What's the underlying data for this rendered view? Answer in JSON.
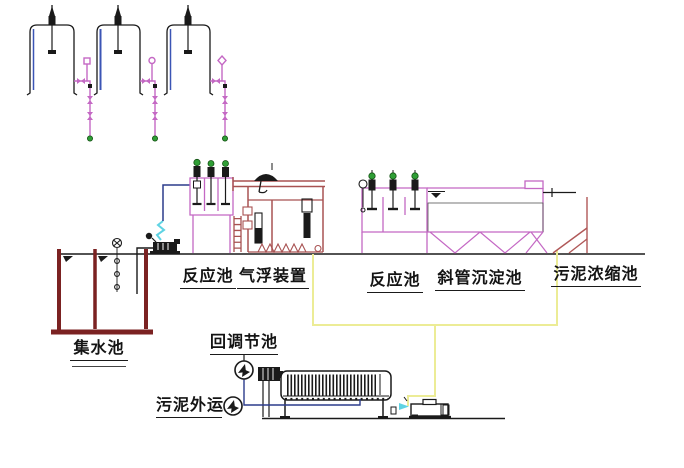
{
  "diagram": {
    "labels": {
      "reaction_tank_1": "反应池",
      "air_flotation_unit": "气浮装置",
      "reaction_tank_2": "反应池",
      "inclined_tube_sedimentation_tank": "斜管沉淀池",
      "sludge_thickening_tank": "污泥浓缩池",
      "collecting_tank": "集水池",
      "return_regulating_tank": "回调节池",
      "sludge_hauling": "污泥外运"
    },
    "colors": {
      "ink": "#1a1a1a",
      "pipe_magenta": "#c468c4",
      "structure_red": "#a85252",
      "thickener_red": "#b05858",
      "wall_maroon": "#7b2222",
      "sludge_yellow": "#ecec96",
      "water_blue": "#2c3c8c",
      "hose_cyan": "#5fd3e3",
      "dot_green": "#2f9e35",
      "dot_ring": "#145214",
      "level_blue": "#3b55b5"
    }
  }
}
